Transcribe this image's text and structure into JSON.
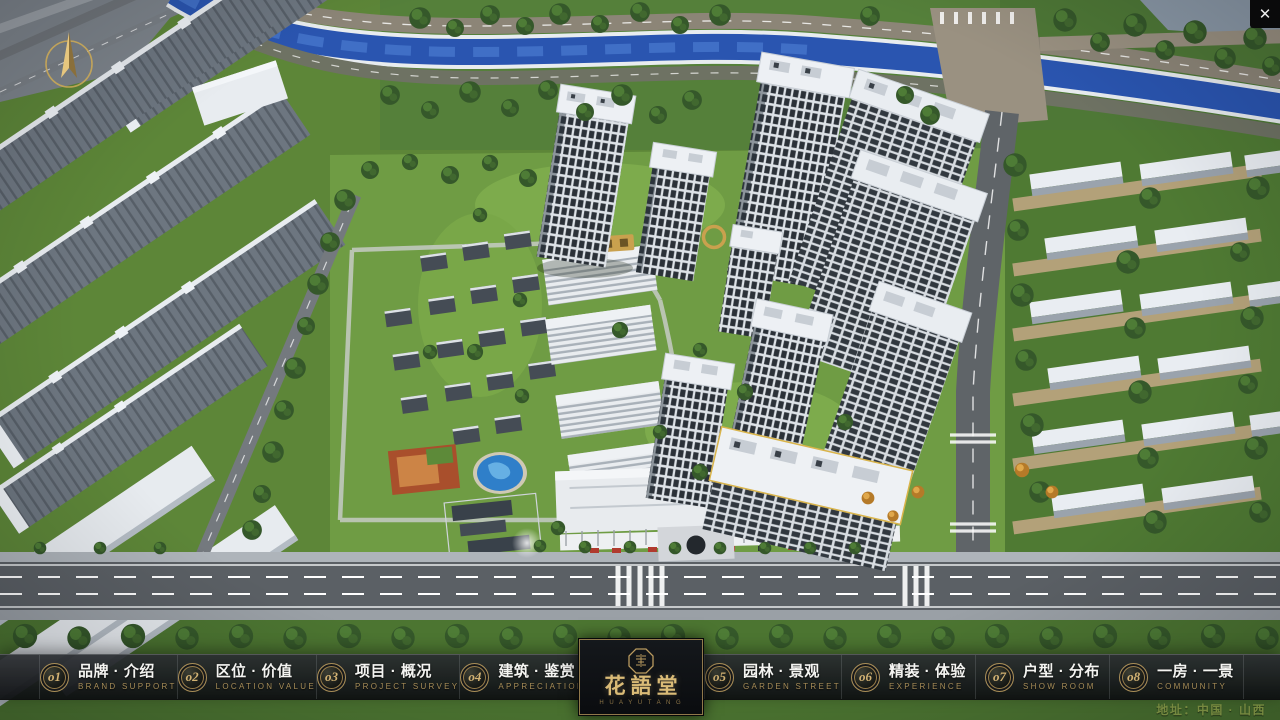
{
  "window": {
    "close_icon": "✕"
  },
  "nav": {
    "items": [
      {
        "num": "o1",
        "zh": "品牌 · 介绍",
        "en": "BRAND SUPPORT"
      },
      {
        "num": "o2",
        "zh": "区位 · 价值",
        "en": "LOCATION VALUE"
      },
      {
        "num": "o3",
        "zh": "项目 · 概况",
        "en": "PROJECT SURVEY"
      },
      {
        "num": "o4",
        "zh": "建筑 · 鉴赏",
        "en": "APPRECIATION"
      },
      {
        "num": "o5",
        "zh": "园林 · 景观",
        "en": "GARDEN STREET"
      },
      {
        "num": "o6",
        "zh": "精装 · 体验",
        "en": "EXPERIENCE"
      },
      {
        "num": "o7",
        "zh": "户型 · 分布",
        "en": "SHOW ROOM"
      },
      {
        "num": "o8",
        "zh": "一房 · 一景",
        "en": "COMMUNITY"
      }
    ]
  },
  "logo": {
    "title": "花語堂",
    "subtitle": "H U A   Y U   T A N G"
  },
  "footer": {
    "address": "地址：中国 · 山西"
  },
  "colors": {
    "gold_accent": "#b99a5f",
    "nav_bg": "#141619",
    "river_blue": "#2a55b0",
    "grass_green": "#6f9c44"
  }
}
